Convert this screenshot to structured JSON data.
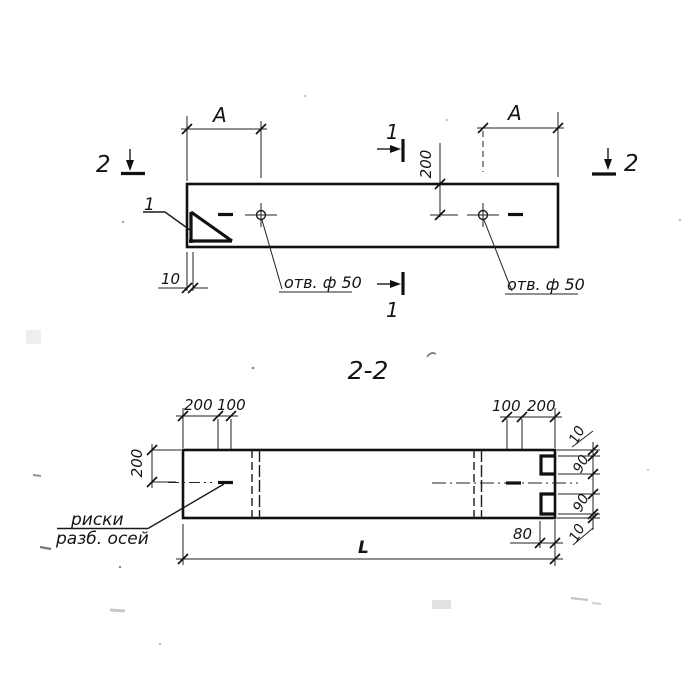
{
  "drawing": {
    "section_title": "2-2",
    "plan": {
      "dim_a_left": "A",
      "dim_a_right": "A",
      "dim_200_to_axis": "200",
      "dim_10_lip": "10",
      "detail_label": "1",
      "hole_label_left": "отв. ф 50",
      "hole_label_right": "отв. ф 50",
      "section1_top": "1",
      "section1_bottom": "1",
      "section2_left": "2",
      "section2_right": "2"
    },
    "section": {
      "dim_left_chain": [
        "200",
        "100"
      ],
      "dim_right_chain": [
        "100",
        "200"
      ],
      "dim_height_200": "200",
      "dim_end_chain": [
        "10",
        "90",
        "90",
        "10"
      ],
      "dim_notch_depth": "80",
      "dim_length": "L",
      "axis_label_line1": "риски",
      "axis_label_line2": "разб. осей"
    },
    "colors": {
      "ink": "#1b1b1b",
      "paper": "#ffffff"
    }
  }
}
